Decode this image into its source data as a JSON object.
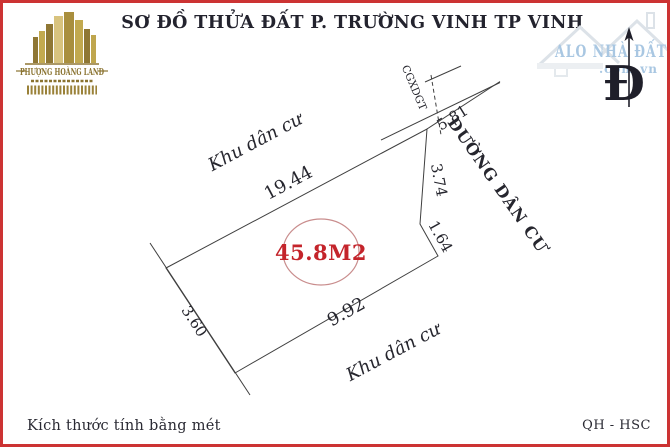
{
  "title": "SƠ ĐỒ THỬA ĐẤT P. TRƯỜNG VINH TP VINH",
  "logo_left": {
    "name": "PHƯỢNG HOÀNG LAND"
  },
  "logo_right": {
    "name": "ALO NHÀ ĐẤT",
    "domain": ".com.vn"
  },
  "compass_label": "Đ",
  "plot": {
    "area": "45.8M2",
    "edges": {
      "top": "19.44",
      "road_frontage": "5.81",
      "right_upper": "3.74",
      "right_lower": "1.64",
      "bottom": "9.92",
      "left": "3.60"
    },
    "surroundings": {
      "top": "Khu dân cư",
      "bottom": "Khu dân cư",
      "road": "ĐƯỜNG DÂN CƯ",
      "boundary_marker": "CGXDGT"
    }
  },
  "footer": {
    "note": "Kích thước tính bằng mét",
    "ref": "QH - HSC"
  },
  "colors": {
    "border_red": "#cc3333",
    "area_red": "#c4242b",
    "circle_pink": "#c98d8d",
    "logo_gold": "#9a8138",
    "logo_blue": "#a9c7e2",
    "line_dark": "#3f3f3f"
  }
}
